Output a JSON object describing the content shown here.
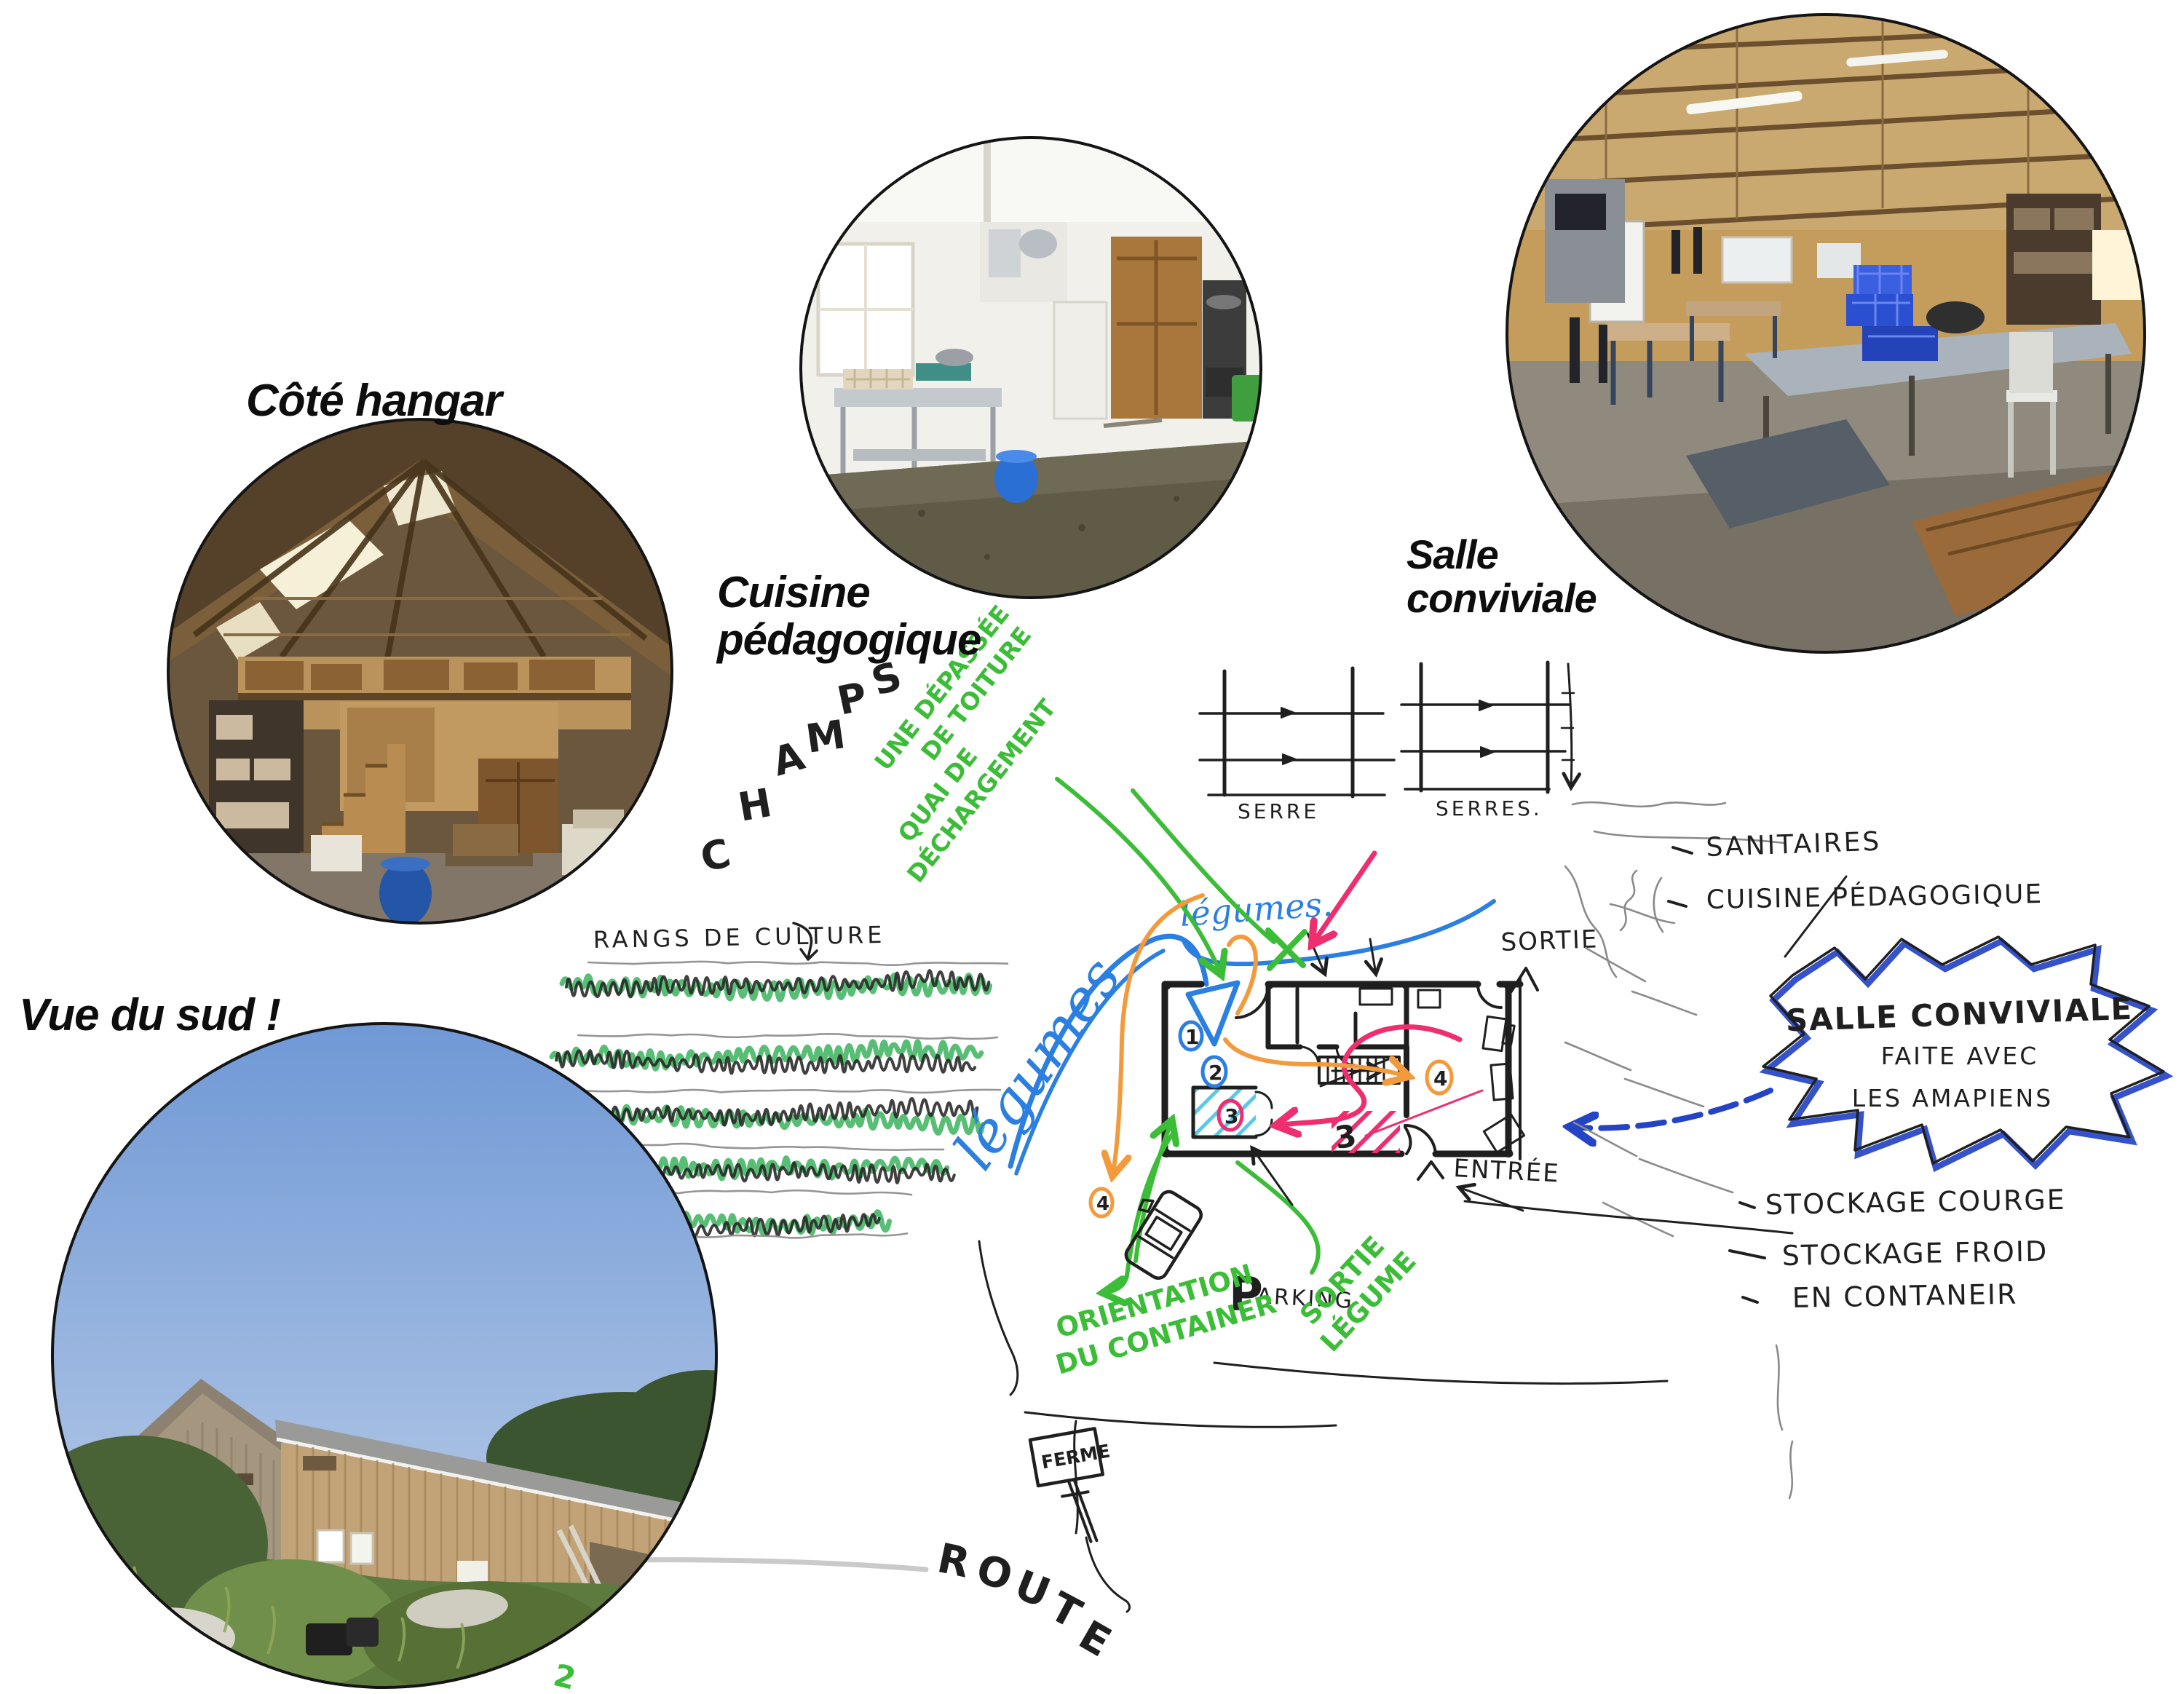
{
  "colors": {
    "paper": "#ffffff",
    "ink": "#1f1f1f",
    "pencil": "#8a8a8a",
    "marker_green": "#3cbd37",
    "marker_blue": "#2b7fe0",
    "marker_dark_blue": "#2443c6",
    "marker_pink": "#ee2e6e",
    "marker_orange": "#f39a3c",
    "marker_cyan": "#5ac8e8"
  },
  "photo_labels": {
    "hangar": "Côté hangar",
    "cuisine_l1": "Cuisine",
    "cuisine_l2": "pédagogique",
    "salle_l1": "Salle",
    "salle_l2": "conviviale",
    "sud": "Vue du sud !"
  },
  "sketch": {
    "champs": [
      "C",
      "H",
      "A",
      "M",
      "P",
      "S"
    ],
    "note_toiture_l1": "UNE DÉPASSÉE",
    "note_toiture_l2": "DE TOITURE",
    "note_quai_l1": "QUAI DE",
    "note_quai_l2": "DÉCHARGEMENT",
    "rangs": "RANGS DE CULTURE",
    "legumes_big": "légumes",
    "legumes_small": "légumes.",
    "serre": "SERRE",
    "serres": "SERRES.",
    "sanitaires": "SANITAIRES",
    "cuisine_pedagogique": "CUISINE PÉDAGOGIQUE",
    "sortie": "SORTIE",
    "entree": "ENTRÉE",
    "star_l1": "SALLE CONVIVIALE",
    "star_l2": "FAITE AVEC",
    "star_l3": "LES AMAPIENS",
    "stockage_l1": "STOCKAGE COURGE",
    "stockage_l2": "STOCKAGE FROID",
    "stockage_l3": "EN CONTANEIR",
    "parking_initial": "P",
    "parking_rest": "ARKING",
    "orientation_l1": "ORIENTATION",
    "orientation_l2": "DU CONTAINER",
    "sortie_legumes_l1": "SORTIE",
    "sortie_legumes_l2": "LÉGUME",
    "route": [
      "R",
      "O",
      "U",
      "T",
      "E"
    ],
    "ferme": "FERME",
    "markers": {
      "one": "1",
      "two": "2",
      "three": "3",
      "three_b": "3",
      "four": "4",
      "four_b": "4",
      "green_two": "2"
    }
  }
}
